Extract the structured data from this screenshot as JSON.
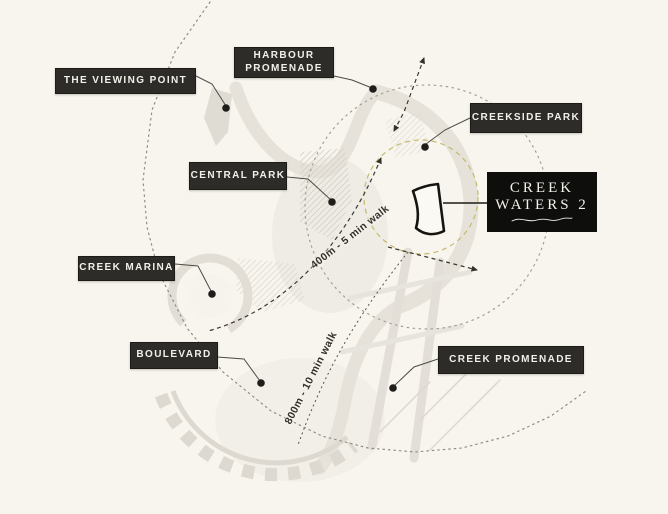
{
  "map": {
    "title": "Creek Waters 2 location map",
    "locations": [
      {
        "name": "the-viewing-point",
        "label": "THE VIEWING POINT"
      },
      {
        "name": "harbour-promenade",
        "label": "HARBOUR PROMENADE"
      },
      {
        "name": "creekside-park",
        "label": "CREEKSIDE PARK"
      },
      {
        "name": "central-park",
        "label": "CENTRAL PARK"
      },
      {
        "name": "creek-marina",
        "label": "CREEK MARINA"
      },
      {
        "name": "boulevard",
        "label": "BOULEVARD"
      },
      {
        "name": "creek-promenade",
        "label": "CREEK PROMENADE"
      }
    ],
    "site": {
      "line1": "CREEK",
      "line2": "WATERS 2"
    },
    "distance_rings": [
      {
        "label": "400m - 5 min walk"
      },
      {
        "label": "800m - 10 min walk"
      }
    ],
    "colors": {
      "background": "#f8f5ef",
      "label_background": "#2d2c28",
      "label_text": "#f3f0e9",
      "site_box_background": "#0e0e0c",
      "site_ring_accent": "#c4ba6e",
      "route_line": "#3a3833",
      "road": "#e6e2da"
    }
  }
}
